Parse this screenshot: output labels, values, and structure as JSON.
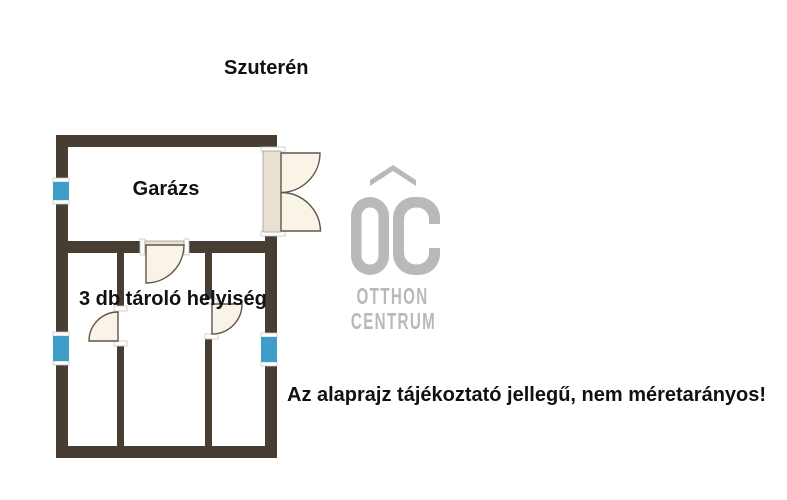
{
  "title": "Szuterén",
  "rooms": {
    "garage": "Garázs",
    "storage": "3 db tároló helyiség"
  },
  "disclaimer": "Az alaprajz tájékoztató jellegű, nem méretarányos!",
  "watermark": {
    "initials": "OC",
    "line1": "OTTHON",
    "line2": "CENTRUM"
  },
  "colors": {
    "background": "#FFFFFF",
    "wall": "#473D33",
    "window": "#3F9DC9",
    "door_fill": "#FAF3E7",
    "door_recess": "#E9E0D1",
    "door_stroke": "#5E564C",
    "watermark": "#B9B9B9",
    "text": "#111111"
  }
}
